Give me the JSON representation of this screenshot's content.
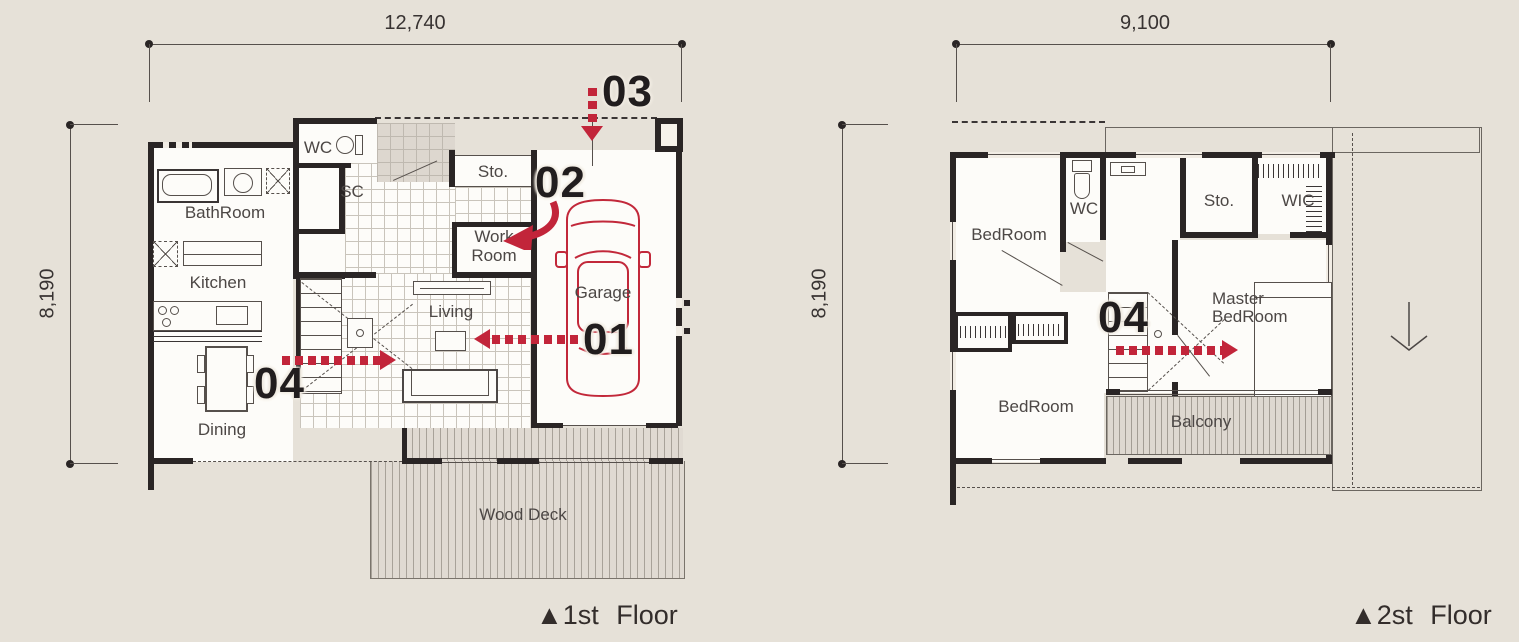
{
  "colors": {
    "background": "#e6e1d8",
    "wall_ink": "#2a2525",
    "accent_red": "#c2253a",
    "label_grey": "#4c4745"
  },
  "floor1": {
    "width_dim": "12,740",
    "height_dim": "8,190",
    "floor_label": {
      "icon": "▲",
      "text": "1st Floor"
    },
    "rooms": {
      "bathroom": "BathRoom",
      "wc": "WC",
      "sc": "SC",
      "sto": "Sto.",
      "work_room": [
        "Work",
        "Room"
      ],
      "kitchen": "Kitchen",
      "living": "Living",
      "dining": "Dining",
      "garage": "Garage",
      "wood_deck": "Wood Deck"
    },
    "markers": {
      "m01": "01",
      "m02": "02",
      "m03": "03",
      "m04": "04"
    }
  },
  "floor2": {
    "width_dim": "9,100",
    "height_dim": "8,190",
    "floor_label": {
      "icon": "▲",
      "text": "2st Floor"
    },
    "rooms": {
      "bedroom_upper": "BedRoom",
      "wc": "WC",
      "sto": "Sto.",
      "wic": "WIC",
      "master_bedroom": [
        "Master",
        "BedRoom"
      ],
      "bedroom_lower": "BedRoom",
      "balcony": "Balcony"
    },
    "markers": {
      "m04": "04"
    }
  }
}
